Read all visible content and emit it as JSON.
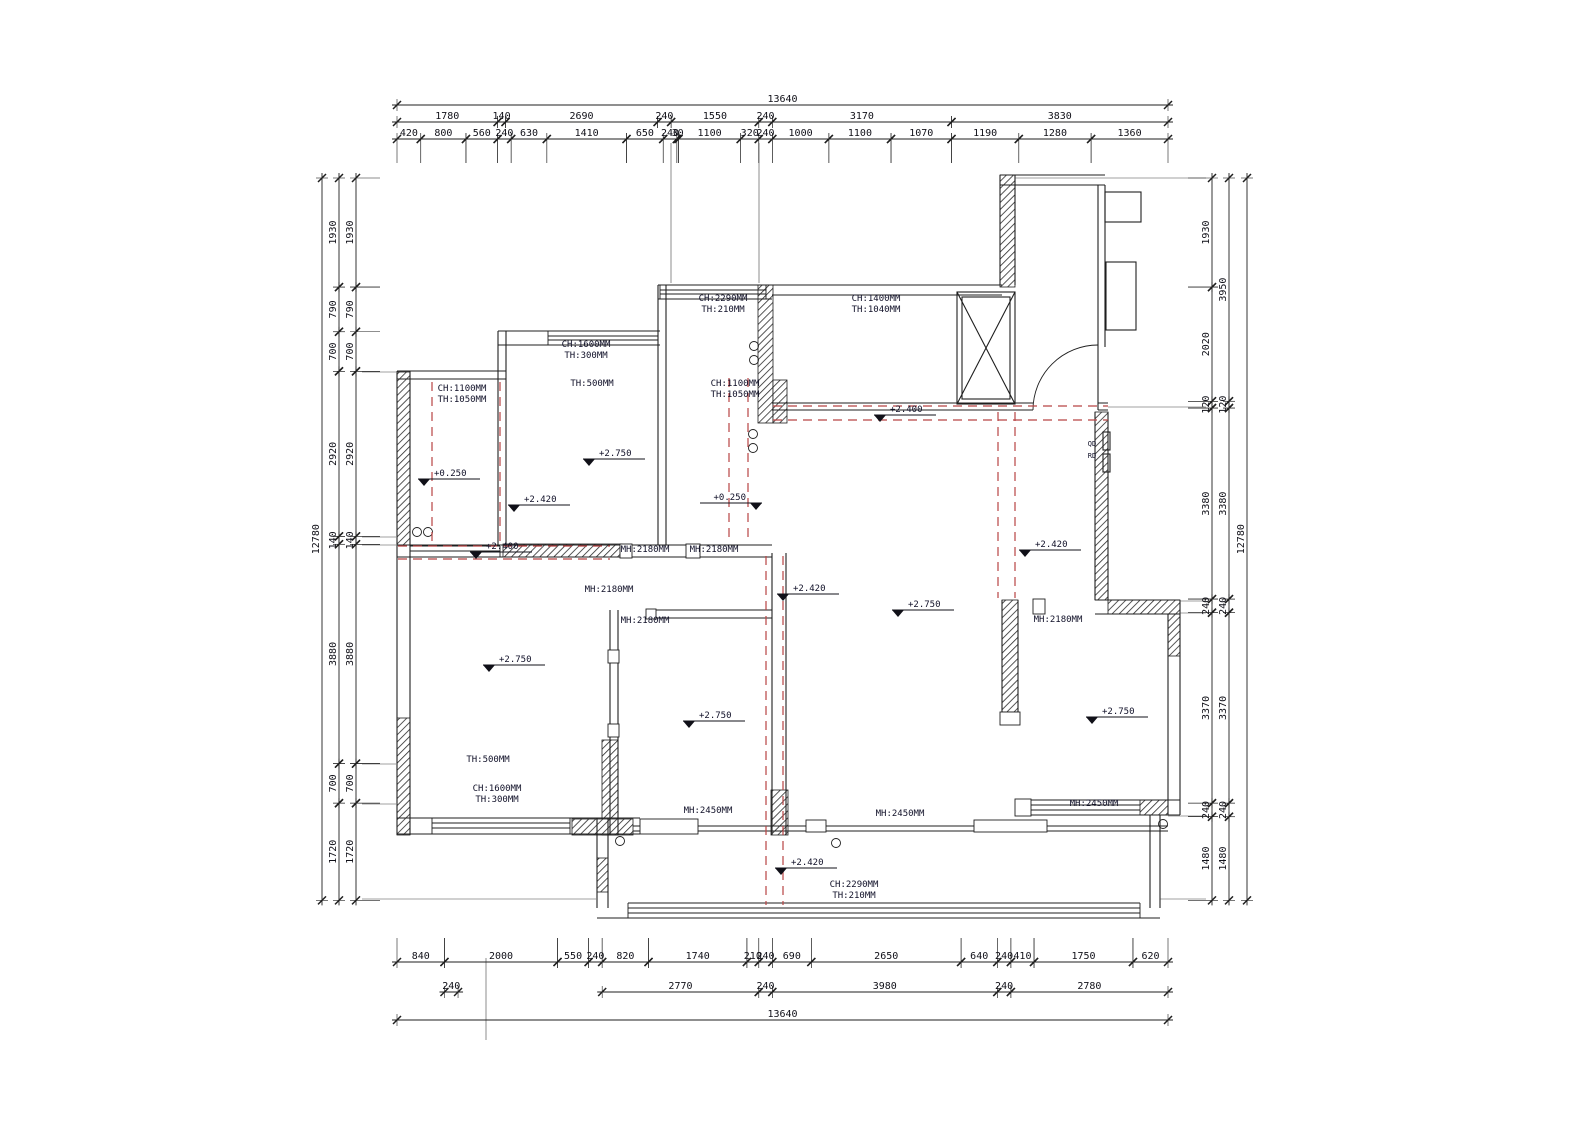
{
  "colors": {
    "background": "#ffffff",
    "line": "#1f1f1f",
    "beam_dashed": "#b84444",
    "text": "#101018"
  },
  "dimensions": {
    "scale_px_per_mm": 0.056525,
    "top": {
      "x_start": 397,
      "rows": [
        {
          "y": 105,
          "segments": [
            13640
          ]
        },
        {
          "y": 122,
          "segments": [
            1780,
            140,
            2690,
            240,
            1550,
            240,
            3170,
            3830
          ]
        },
        {
          "y": 139,
          "segments": [
            420,
            800,
            560,
            240,
            630,
            1410,
            650,
            240,
            30,
            1100,
            320,
            240,
            1000,
            1100,
            1070,
            1190,
            1280,
            1360
          ]
        }
      ]
    },
    "bottom": {
      "x_start": 397,
      "rows": [
        {
          "y": 962,
          "segments": [
            840,
            2000,
            550,
            240,
            820,
            1740,
            210,
            240,
            690,
            2650,
            640,
            240,
            410,
            1750,
            620
          ]
        },
        {
          "y": 992,
          "segments": [
            {
              "at": 840,
              "len": 240
            },
            {
              "at": 3630,
              "len": 2770
            },
            {
              "at": 6400,
              "len": 240
            },
            {
              "at": 6640,
              "len": 3980
            },
            {
              "at": 10620,
              "len": 240
            },
            {
              "at": 10860,
              "len": 2780
            }
          ]
        },
        {
          "y": 1020,
          "segments": [
            13640
          ]
        }
      ]
    },
    "left": {
      "y_start": 178,
      "cols": [
        {
          "x": 322,
          "segments": [
            12780
          ]
        },
        {
          "x": 339,
          "segments": [
            1930,
            790,
            700,
            2920,
            140,
            3880,
            700,
            1720
          ]
        },
        {
          "x": 356,
          "segments": [
            1930,
            790,
            700,
            2920,
            140,
            3880,
            700,
            1720
          ]
        }
      ]
    },
    "right": {
      "y_start": 178,
      "cols": [
        {
          "x": 1212,
          "segments": [
            1930,
            2020,
            120,
            3380,
            240,
            3370,
            240,
            1480
          ]
        },
        {
          "x": 1229,
          "segments": [
            3950,
            120,
            3380,
            240,
            3370,
            240,
            1480
          ]
        },
        {
          "x": 1247,
          "segments": [
            12780
          ]
        }
      ]
    }
  },
  "annotations": {
    "room_labels": [
      {
        "lines": [
          "CH:1100MM",
          "TH:1050MM"
        ],
        "x": 462,
        "y": 391
      },
      {
        "lines": [
          "CH:1600MM",
          "TH:300MM"
        ],
        "x": 586,
        "y": 347
      },
      {
        "lines": [
          "TH:500MM"
        ],
        "x": 592,
        "y": 386
      },
      {
        "lines": [
          "CH:2290MM",
          "TH:210MM"
        ],
        "x": 723,
        "y": 301
      },
      {
        "lines": [
          "CH:1100MM",
          "TH:1050MM"
        ],
        "x": 735,
        "y": 386
      },
      {
        "lines": [
          "CH:1400MM",
          "TH:1040MM"
        ],
        "x": 876,
        "y": 301
      },
      {
        "lines": [
          "TH:500MM"
        ],
        "x": 488,
        "y": 762
      },
      {
        "lines": [
          "CH:1600MM",
          "TH:300MM"
        ],
        "x": 497,
        "y": 791
      },
      {
        "lines": [
          "CH:2290MM",
          "TH:210MM"
        ],
        "x": 854,
        "y": 887
      },
      {
        "lines": [
          "MH:2180MM"
        ],
        "x": 645,
        "y": 552
      },
      {
        "lines": [
          "MH:2180MM"
        ],
        "x": 714,
        "y": 552
      },
      {
        "lines": [
          "MH:2180MM"
        ],
        "x": 609,
        "y": 592
      },
      {
        "lines": [
          "MH:2180MM"
        ],
        "x": 645,
        "y": 623
      },
      {
        "lines": [
          "MH:2180MM"
        ],
        "x": 1058,
        "y": 622
      },
      {
        "lines": [
          "MH:2450MM"
        ],
        "x": 708,
        "y": 813
      },
      {
        "lines": [
          "MH:2450MM"
        ],
        "x": 900,
        "y": 816
      },
      {
        "lines": [
          "MH:2450MM"
        ],
        "x": 1094,
        "y": 806
      },
      {
        "lines": [
          "QD"
        ],
        "x": 1092,
        "y": 446,
        "size": 7
      },
      {
        "lines": [
          "RD"
        ],
        "x": 1092,
        "y": 458,
        "size": 7
      }
    ],
    "elevation_markers": [
      {
        "text": "+0.250",
        "x": 418,
        "y": 479
      },
      {
        "text": "+2.420",
        "x": 508,
        "y": 505
      },
      {
        "text": "+2.400",
        "x": 470,
        "y": 552
      },
      {
        "text": "+2.750",
        "x": 583,
        "y": 459
      },
      {
        "text": "+0.250",
        "x": 762,
        "y": 503,
        "align": "left"
      },
      {
        "text": "+2.400",
        "x": 874,
        "y": 415
      },
      {
        "text": "+2.420",
        "x": 777,
        "y": 594
      },
      {
        "text": "+2.750",
        "x": 892,
        "y": 610
      },
      {
        "text": "+2.420",
        "x": 1019,
        "y": 550
      },
      {
        "text": "+2.750",
        "x": 483,
        "y": 665
      },
      {
        "text": "+2.750",
        "x": 683,
        "y": 721
      },
      {
        "text": "+2.750",
        "x": 1086,
        "y": 717
      },
      {
        "text": "+2.420",
        "x": 775,
        "y": 868
      }
    ]
  }
}
